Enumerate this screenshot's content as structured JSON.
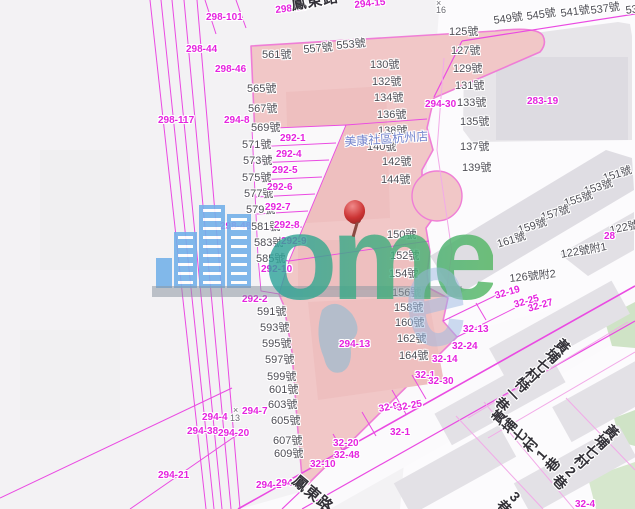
{
  "map_title": "cadastral-parcel-map",
  "poi_labels": [
    {
      "t": "美康社區杭州店",
      "x": 344,
      "y": 136,
      "r": -4
    }
  ],
  "roads": [
    {
      "t": "鳳東路",
      "x": 290,
      "y": -2,
      "r": -10,
      "size": 15
    },
    {
      "t": "鳳東路",
      "x": 299,
      "y": 473,
      "r": 40,
      "size": 15
    },
    {
      "t": "黃埔七村特一巷",
      "x": 563,
      "y": 336,
      "r": 46,
      "mode": "v",
      "size": 14
    },
    {
      "t": "黃埔七村1巷",
      "x": 489,
      "y": 417,
      "r": -48,
      "mode": "v",
      "size": 14
    },
    {
      "t": "黃埔七村2巷",
      "x": 612,
      "y": 422,
      "r": 46,
      "mode": "v",
      "size": 14
    },
    {
      "t": "3巷",
      "x": 516,
      "y": 486,
      "r": 46,
      "mode": "v",
      "size": 14
    }
  ],
  "house_numbers": [
    {
      "t": "561號",
      "x": 262,
      "y": 50
    },
    {
      "t": "557號",
      "x": 303,
      "y": 45,
      "r": -5
    },
    {
      "t": "553號",
      "x": 336,
      "y": 41,
      "r": -5
    },
    {
      "t": "565號",
      "x": 247,
      "y": 84
    },
    {
      "t": "567號",
      "x": 248,
      "y": 104
    },
    {
      "t": "569號",
      "x": 251,
      "y": 123
    },
    {
      "t": "571號",
      "x": 242,
      "y": 140
    },
    {
      "t": "573號",
      "x": 243,
      "y": 156
    },
    {
      "t": "575號",
      "x": 242,
      "y": 173
    },
    {
      "t": "577號",
      "x": 244,
      "y": 189
    },
    {
      "t": "579號",
      "x": 246,
      "y": 205
    },
    {
      "t": "581號",
      "x": 251,
      "y": 222
    },
    {
      "t": "583號",
      "x": 254,
      "y": 238
    },
    {
      "t": "585號",
      "x": 256,
      "y": 254
    },
    {
      "t": "591號",
      "x": 257,
      "y": 307
    },
    {
      "t": "593號",
      "x": 260,
      "y": 323
    },
    {
      "t": "595號",
      "x": 262,
      "y": 339
    },
    {
      "t": "597號",
      "x": 265,
      "y": 355
    },
    {
      "t": "599號",
      "x": 267,
      "y": 372
    },
    {
      "t": "601號",
      "x": 269,
      "y": 385
    },
    {
      "t": "603號",
      "x": 268,
      "y": 400
    },
    {
      "t": "605號",
      "x": 271,
      "y": 416
    },
    {
      "t": "607號",
      "x": 273,
      "y": 436
    },
    {
      "t": "609號",
      "x": 274,
      "y": 449
    },
    {
      "t": "130號",
      "x": 370,
      "y": 60
    },
    {
      "t": "132號",
      "x": 372,
      "y": 77
    },
    {
      "t": "134號",
      "x": 374,
      "y": 93
    },
    {
      "t": "136號",
      "x": 377,
      "y": 110
    },
    {
      "t": "138號",
      "x": 378,
      "y": 126
    },
    {
      "t": "140號",
      "x": 367,
      "y": 142
    },
    {
      "t": "142號",
      "x": 382,
      "y": 157
    },
    {
      "t": "144號",
      "x": 381,
      "y": 175
    },
    {
      "t": "150號",
      "x": 387,
      "y": 230
    },
    {
      "t": "152號",
      "x": 390,
      "y": 251
    },
    {
      "t": "154號",
      "x": 389,
      "y": 269
    },
    {
      "t": "156號",
      "x": 392,
      "y": 288
    },
    {
      "t": "158號",
      "x": 394,
      "y": 303
    },
    {
      "t": "160號",
      "x": 395,
      "y": 318
    },
    {
      "t": "162號",
      "x": 397,
      "y": 334
    },
    {
      "t": "164號",
      "x": 399,
      "y": 351
    },
    {
      "t": "125號",
      "x": 449,
      "y": 27
    },
    {
      "t": "127號",
      "x": 451,
      "y": 46
    },
    {
      "t": "129號",
      "x": 453,
      "y": 64
    },
    {
      "t": "131號",
      "x": 455,
      "y": 81
    },
    {
      "t": "133號",
      "x": 457,
      "y": 98
    },
    {
      "t": "135號",
      "x": 460,
      "y": 117
    },
    {
      "t": "549號",
      "x": 493,
      "y": 16,
      "r": -8
    },
    {
      "t": "545號",
      "x": 526,
      "y": 12,
      "r": -8
    },
    {
      "t": "541號",
      "x": 560,
      "y": 9,
      "r": -8
    },
    {
      "t": "537號",
      "x": 590,
      "y": 6,
      "r": -8
    },
    {
      "t": "53",
      "x": 625,
      "y": 6,
      "r": -8
    },
    {
      "t": "137號",
      "x": 460,
      "y": 142
    },
    {
      "t": "139號",
      "x": 462,
      "y": 163
    },
    {
      "t": "151號",
      "x": 602,
      "y": 174,
      "r": -17
    },
    {
      "t": "153號",
      "x": 583,
      "y": 187,
      "r": -17
    },
    {
      "t": "155號",
      "x": 563,
      "y": 199,
      "r": -17
    },
    {
      "t": "157號",
      "x": 540,
      "y": 213,
      "r": -17
    },
    {
      "t": "159號",
      "x": 517,
      "y": 226,
      "r": -17
    },
    {
      "t": "161號",
      "x": 496,
      "y": 240,
      "r": -17
    },
    {
      "t": "122號",
      "x": 609,
      "y": 226,
      "r": -12
    },
    {
      "t": "122號附1",
      "x": 560,
      "y": 250,
      "r": -10
    },
    {
      "t": "126號附2",
      "x": 509,
      "y": 274,
      "r": -6
    }
  ],
  "parcel_codes": [
    {
      "t": "298-101",
      "x": 206,
      "y": 13
    },
    {
      "t": "298-58",
      "x": 275,
      "y": 6,
      "r": -6
    },
    {
      "t": "294-15",
      "x": 354,
      "y": 1,
      "r": -6
    },
    {
      "t": "298-44",
      "x": 186,
      "y": 45
    },
    {
      "t": "298-46",
      "x": 215,
      "y": 65
    },
    {
      "t": "298-117",
      "x": 158,
      "y": 116
    },
    {
      "t": "294-8",
      "x": 224,
      "y": 116
    },
    {
      "t": "292-1",
      "x": 280,
      "y": 134
    },
    {
      "t": "292-4",
      "x": 276,
      "y": 150
    },
    {
      "t": "292-5",
      "x": 272,
      "y": 166
    },
    {
      "t": "292-6",
      "x": 267,
      "y": 183
    },
    {
      "t": "292-7",
      "x": 265,
      "y": 203
    },
    {
      "t": "292-8",
      "x": 274,
      "y": 221
    },
    {
      "t": "292-9",
      "x": 281,
      "y": 237
    },
    {
      "t": "298-48",
      "x": 220,
      "y": 222
    },
    {
      "t": "292-10",
      "x": 261,
      "y": 265
    },
    {
      "t": "292-2",
      "x": 242,
      "y": 295
    },
    {
      "t": "294-13",
      "x": 339,
      "y": 340
    },
    {
      "t": "294-7",
      "x": 242,
      "y": 407
    },
    {
      "t": "294-4",
      "x": 202,
      "y": 413
    },
    {
      "t": "294-38",
      "x": 187,
      "y": 427
    },
    {
      "t": "294-20",
      "x": 218,
      "y": 429
    },
    {
      "t": "294-21",
      "x": 158,
      "y": 471
    },
    {
      "t": "294-1",
      "x": 256,
      "y": 481
    },
    {
      "t": "294-36",
      "x": 276,
      "y": 479
    },
    {
      "t": "294-30",
      "x": 425,
      "y": 100
    },
    {
      "t": "283-19",
      "x": 527,
      "y": 97
    },
    {
      "t": "32-19",
      "x": 494,
      "y": 292,
      "r": -16
    },
    {
      "t": "32-25",
      "x": 513,
      "y": 301,
      "r": -16
    },
    {
      "t": "32-27",
      "x": 527,
      "y": 305,
      "r": -16
    },
    {
      "t": "32-13",
      "x": 463,
      "y": 325
    },
    {
      "t": "32-24",
      "x": 452,
      "y": 342
    },
    {
      "t": "32-14",
      "x": 432,
      "y": 355
    },
    {
      "t": "32-1",
      "x": 415,
      "y": 371
    },
    {
      "t": "32-30",
      "x": 428,
      "y": 377
    },
    {
      "t": "32-9",
      "x": 378,
      "y": 405,
      "r": -10
    },
    {
      "t": "32-25",
      "x": 396,
      "y": 404,
      "r": -10
    },
    {
      "t": "32-1",
      "x": 390,
      "y": 428
    },
    {
      "t": "32-20",
      "x": 333,
      "y": 439
    },
    {
      "t": "32-48",
      "x": 334,
      "y": 451
    },
    {
      "t": "32-10",
      "x": 310,
      "y": 460
    },
    {
      "t": "32-4",
      "x": 575,
      "y": 500
    },
    {
      "t": "28",
      "x": 604,
      "y": 232
    }
  ],
  "misc_marks": [
    {
      "t": "×",
      "x": 436,
      "y": -1
    },
    {
      "t": "16",
      "x": 436,
      "y": 6
    },
    {
      "t": "×",
      "x": 233,
      "y": 406
    },
    {
      "t": "13",
      "x": 230,
      "y": 414
    }
  ],
  "watermark": {
    "text": "ome",
    "letter": "e",
    "building_color": "#74b1e9",
    "text_colors": [
      "#2fa39e",
      "#55b763"
    ],
    "pin_color": "#cc3434"
  },
  "colors": {
    "parcel_line": "#ea4ae2",
    "parcel_text": "#e523df",
    "house_text": "#4f4e56",
    "pink_block": "#f1c7c7",
    "pink_border": "#ef7ed6",
    "gray_block": "#e7e5e9",
    "green_area": "#cfe3c6",
    "background": "#f3f2f4"
  }
}
